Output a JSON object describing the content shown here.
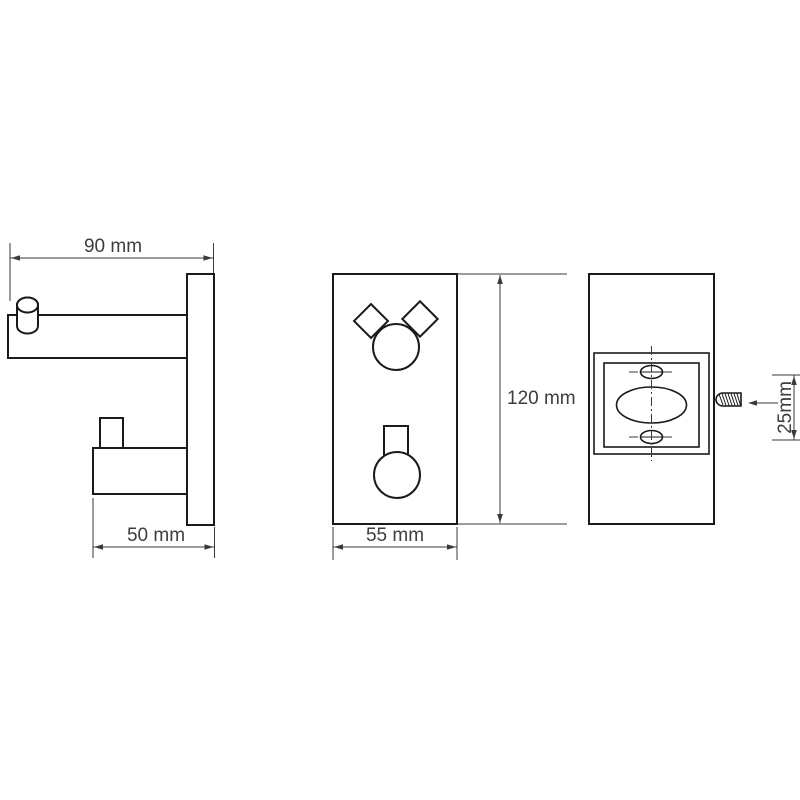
{
  "drawing": {
    "description_labels": {
      "side_view_projection_top": "90 mm",
      "side_view_projection_bottom": "50 mm",
      "front_view_width": "55 mm",
      "front_view_height": "120 mm",
      "back_view_screw_length": "25mm"
    },
    "views": {
      "side": {
        "width_top": "90 mm",
        "depth_bottom": "50 mm"
      },
      "front": {
        "width": "55 mm",
        "height": "120 mm"
      },
      "back": {
        "screw_length": "25mm"
      }
    },
    "colors": {
      "background": "#ffffff",
      "line": "#1a1a1a",
      "dimension": "#3a3a3a",
      "text": "#3d3d3d"
    }
  }
}
